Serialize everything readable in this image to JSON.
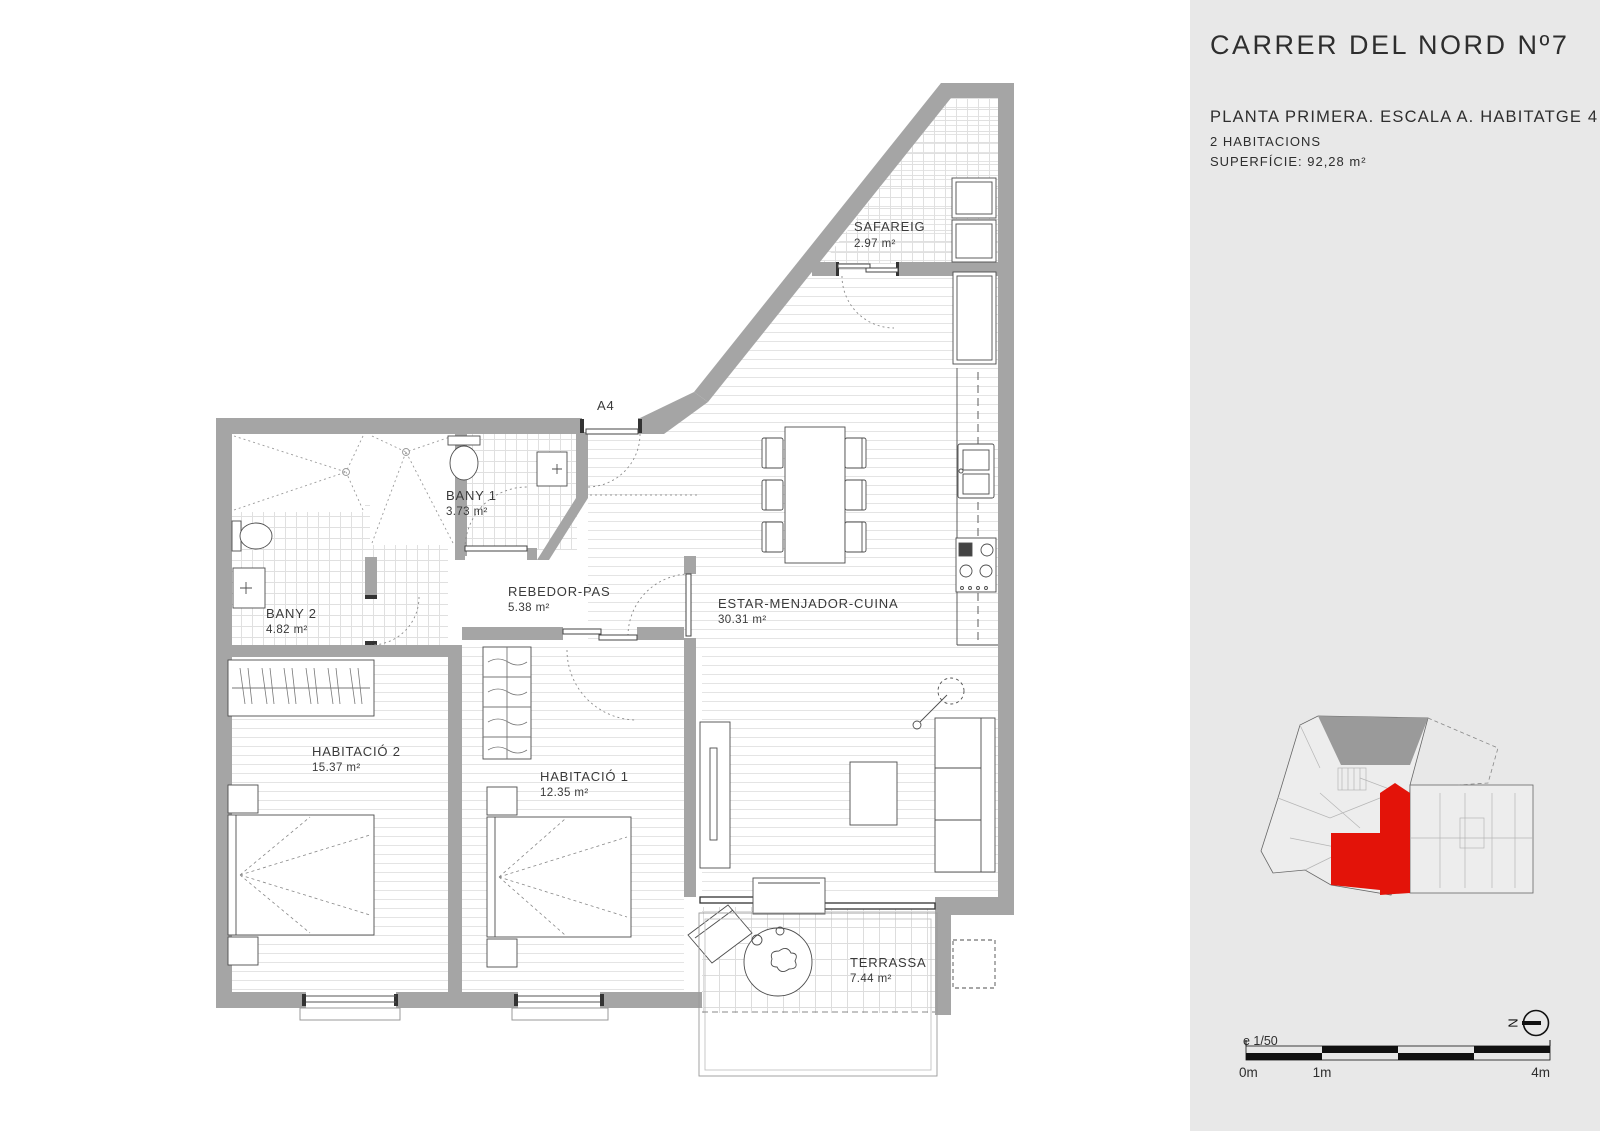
{
  "sidebar": {
    "title": "CARRER DEL NORD Nº7",
    "subtitle": "PLANTA PRIMERA. ESCALA A. HABITATGE 4",
    "rooms_line": "2 HABITACIONS",
    "surface_line": "SUPERFÍCIE: 92,28 m²",
    "scale_label": "e 1/50",
    "scale_ticks": [
      "0m",
      "1m",
      "4m"
    ],
    "north_label": "N",
    "highlight_color": "#e31309",
    "panel_color": "#e8e8e8",
    "wall_color": "#a5a5a5"
  },
  "plan": {
    "entry_label": "A4",
    "rooms": [
      {
        "name": "SAFAREIG",
        "area": "2.97 m²"
      },
      {
        "name": "BANY 1",
        "area": "3.73 m²"
      },
      {
        "name": "BANY 2",
        "area": "4.82 m²"
      },
      {
        "name": "REBEDOR-PAS",
        "area": "5.38 m²"
      },
      {
        "name": "ESTAR-MENJADOR-CUINA",
        "area": "30.31 m²"
      },
      {
        "name": "HABITACIÓ 2",
        "area": "15.37 m²"
      },
      {
        "name": "HABITACIÓ 1",
        "area": "12.35 m²"
      },
      {
        "name": "TERRASSA",
        "area": "7.44 m²"
      }
    ]
  }
}
